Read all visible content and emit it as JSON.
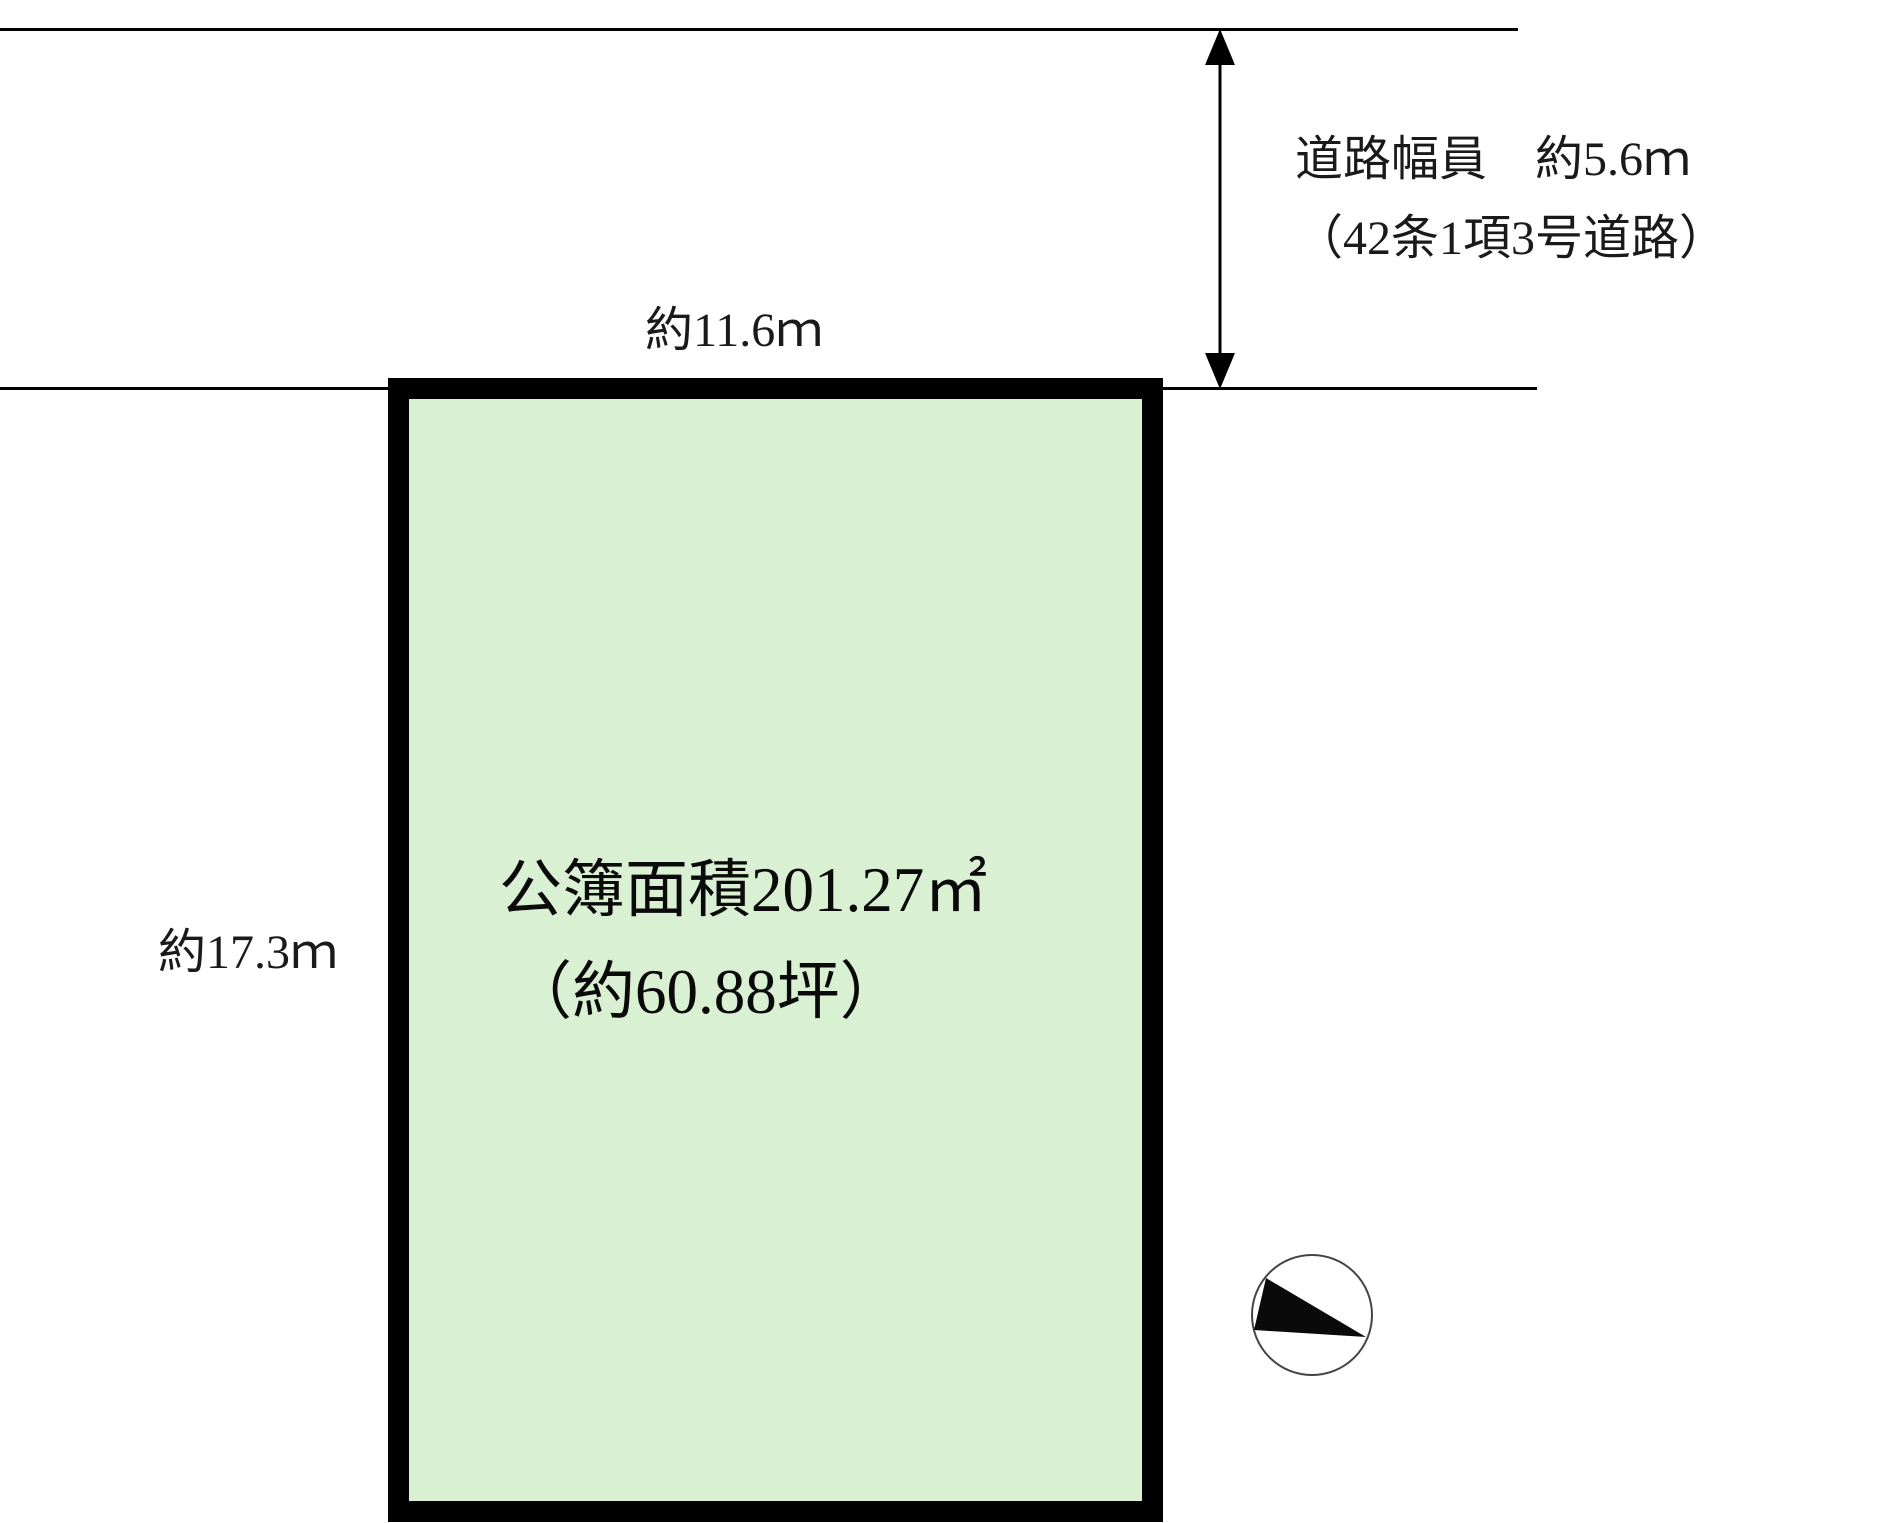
{
  "diagram": {
    "type": "land-plot-layout",
    "road": {
      "width_label_line1": "道路幅員　約5.6ｍ",
      "width_label_line2": "（42条1項3号道路）"
    },
    "dimensions": {
      "top_width": "約11.6ｍ",
      "left_height": "約17.3ｍ"
    },
    "plot": {
      "area_line1": "公簿面積201.27㎡",
      "area_line2": "（約60.88坪）"
    },
    "icons": {
      "compass": "compass-north-indicator",
      "dimension_arrow": "double-headed-vertical-arrow"
    },
    "colors": {
      "plot_fill": "#d9f0d3",
      "plot_border": "#000000",
      "line": "#000000",
      "text": "#1a1a1a",
      "background": "#ffffff"
    }
  }
}
